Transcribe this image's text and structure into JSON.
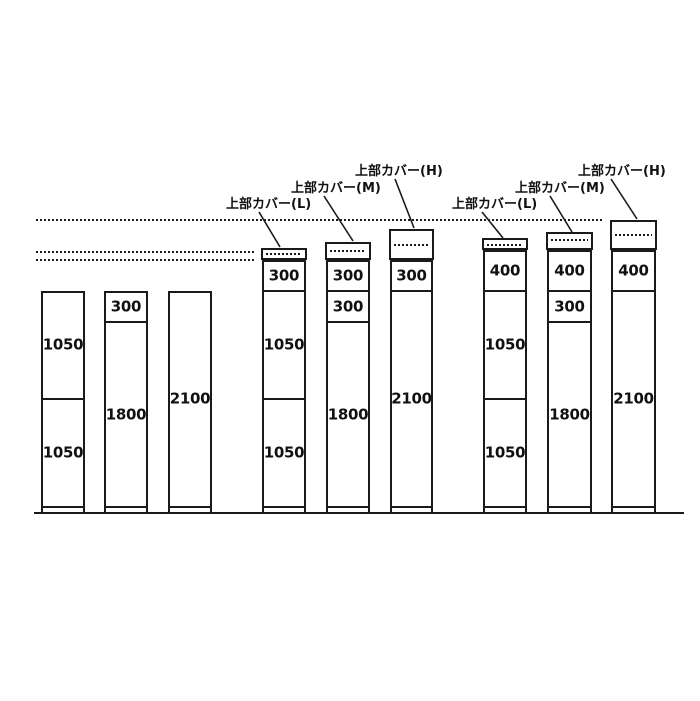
{
  "colors": {
    "background": "#ffffff",
    "line": "#1a1a1a",
    "text": "#111111"
  },
  "diagram": {
    "ground_line": {
      "x1": 34,
      "x2": 684,
      "y": 512
    },
    "level_lines": [
      {
        "name": "upper-height-level",
        "y": 219,
        "x1": 36,
        "x2": 603
      },
      {
        "name": "cover-top-level",
        "y": 251,
        "x1": 36,
        "x2": 254
      },
      {
        "name": "cabinet-top-level",
        "y": 259,
        "x1": 36,
        "x2": 254
      }
    ],
    "cover_labels": [
      {
        "text": "上部カバー(L)",
        "left": 226,
        "top": 198,
        "leader": {
          "x1": 259,
          "y1": 212,
          "x2": 280,
          "y2": 247
        }
      },
      {
        "text": "上部カバー(M)",
        "left": 291,
        "top": 182,
        "leader": {
          "x1": 324,
          "y1": 196,
          "x2": 353,
          "y2": 241
        }
      },
      {
        "text": "上部カバー(H)",
        "left": 355,
        "top": 165,
        "leader": {
          "x1": 395,
          "y1": 179,
          "x2": 414,
          "y2": 228
        }
      },
      {
        "text": "上部カバー(L)",
        "left": 452,
        "top": 198,
        "leader": {
          "x1": 482,
          "y1": 212,
          "x2": 503,
          "y2": 238
        }
      },
      {
        "text": "上部カバー(M)",
        "left": 515,
        "top": 182,
        "leader": {
          "x1": 550,
          "y1": 196,
          "x2": 572,
          "y2": 232
        }
      },
      {
        "text": "上部カバー(H)",
        "left": 578,
        "top": 165,
        "leader": {
          "x1": 611,
          "y1": 179,
          "x2": 637,
          "y2": 219
        }
      }
    ],
    "baseline_y": 514,
    "bars": [
      {
        "x": 41,
        "w": 44,
        "cover": null,
        "sections": [
          {
            "label": "1050",
            "top": 291,
            "bottom": 399
          },
          {
            "label": "1050",
            "top": 399,
            "bottom": 507
          }
        ]
      },
      {
        "x": 104,
        "w": 44,
        "cover": null,
        "sections": [
          {
            "label": "300",
            "top": 291,
            "bottom": 322
          },
          {
            "label": "1800",
            "top": 322,
            "bottom": 507
          }
        ]
      },
      {
        "x": 168,
        "w": 44,
        "cover": null,
        "sections": [
          {
            "label": "2100",
            "top": 291,
            "bottom": 507
          }
        ]
      },
      {
        "x": 262,
        "w": 44,
        "cover": {
          "type": "L",
          "top": 248,
          "dotted_y": 252,
          "bottom": 260
        },
        "sections": [
          {
            "label": "300",
            "top": 260,
            "bottom": 291
          },
          {
            "label": "1050",
            "top": 291,
            "bottom": 399
          },
          {
            "label": "1050",
            "top": 399,
            "bottom": 507
          }
        ]
      },
      {
        "x": 326,
        "w": 44,
        "cover": {
          "type": "M",
          "top": 242,
          "dotted_y": 249,
          "bottom": 260
        },
        "sections": [
          {
            "label": "300",
            "top": 260,
            "bottom": 291
          },
          {
            "label": "300",
            "top": 291,
            "bottom": 322
          },
          {
            "label": "1800",
            "top": 322,
            "bottom": 507
          }
        ]
      },
      {
        "x": 390,
        "w": 43,
        "cover": {
          "type": "H",
          "top": 229,
          "dotted_y": 243,
          "bottom": 260
        },
        "sections": [
          {
            "label": "300",
            "top": 260,
            "bottom": 291
          },
          {
            "label": "2100",
            "top": 291,
            "bottom": 507
          }
        ]
      },
      {
        "x": 483,
        "w": 44,
        "cover": {
          "type": "L",
          "top": 238,
          "dotted_y": 243,
          "bottom": 250
        },
        "sections": [
          {
            "label": "400",
            "top": 250,
            "bottom": 291
          },
          {
            "label": "1050",
            "top": 291,
            "bottom": 399
          },
          {
            "label": "1050",
            "top": 399,
            "bottom": 507
          }
        ]
      },
      {
        "x": 547,
        "w": 45,
        "cover": {
          "type": "M",
          "top": 232,
          "dotted_y": 238,
          "bottom": 250
        },
        "sections": [
          {
            "label": "400",
            "top": 250,
            "bottom": 291
          },
          {
            "label": "300",
            "top": 291,
            "bottom": 322
          },
          {
            "label": "1800",
            "top": 322,
            "bottom": 507
          }
        ]
      },
      {
        "x": 611,
        "w": 45,
        "cover": {
          "type": "H",
          "top": 220,
          "dotted_y": 233,
          "bottom": 250
        },
        "sections": [
          {
            "label": "400",
            "top": 250,
            "bottom": 291
          },
          {
            "label": "2100",
            "top": 291,
            "bottom": 507
          }
        ]
      }
    ]
  }
}
